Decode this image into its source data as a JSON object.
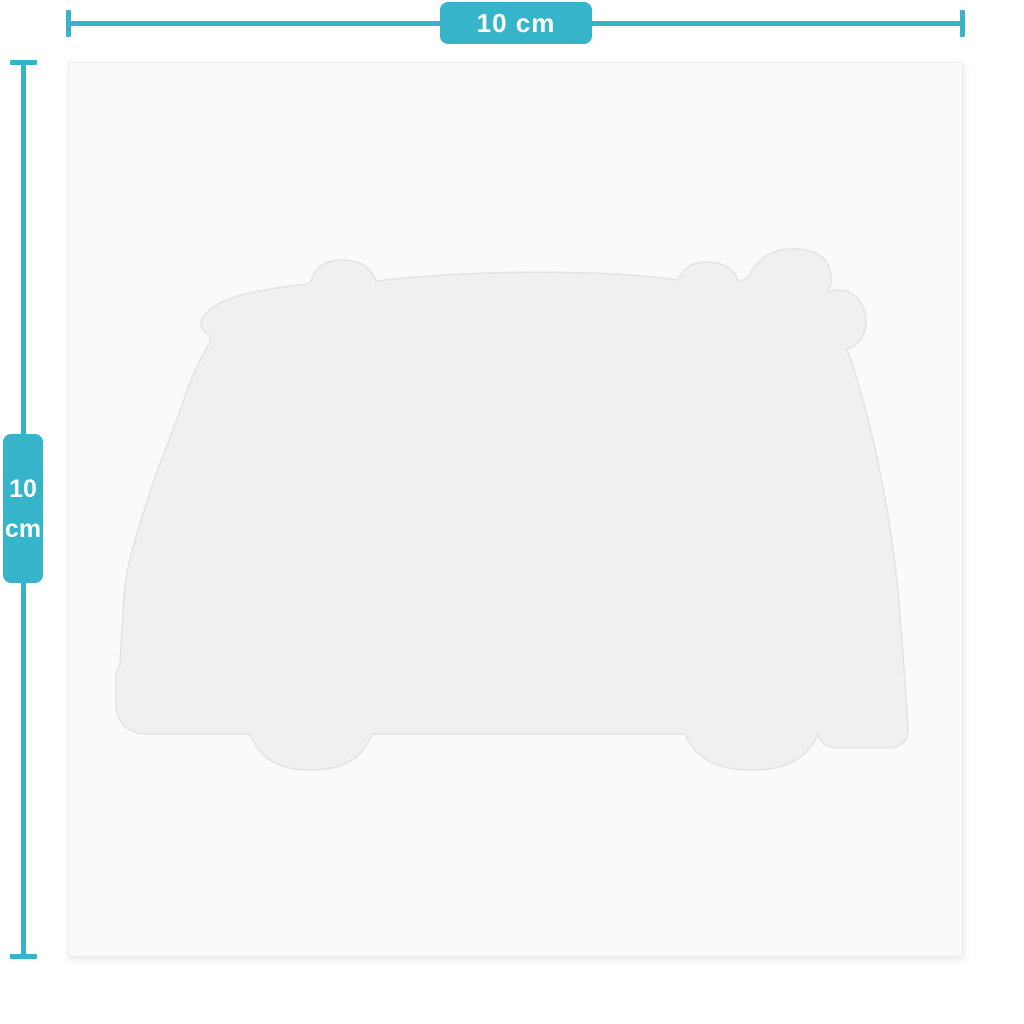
{
  "colors": {
    "accent": "#36b4ca",
    "paper": "#fafaf9",
    "silhouette": "#f0f0ee",
    "silhouette_stroke": "#e2e2de",
    "background": "#ffffff"
  },
  "rulers": {
    "horizontal": {
      "label": "10 cm"
    },
    "vertical": {
      "value": "10",
      "unit": "cm"
    }
  },
  "figure": {
    "silhouette": "camper-van"
  }
}
